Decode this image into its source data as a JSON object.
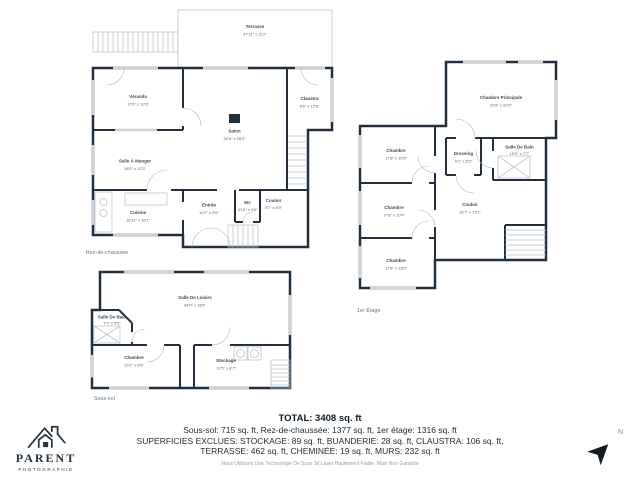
{
  "colors": {
    "wall": "#22303e",
    "line": "#b7c1c9",
    "label_text": "#3c4a56",
    "logo": "#25333f"
  },
  "plans": {
    "rdc": {
      "floor_label": "Rez-de-chaussée",
      "rooms": [
        {
          "name": "Terrasse",
          "dims": "47'11\" x 11'2\""
        },
        {
          "name": "Véranda",
          "dims": "17'6\" x 12'6\""
        },
        {
          "name": "Claustra",
          "dims": "8'6\" x 12'6\""
        },
        {
          "name": "Salon",
          "dims": "20'8\" x 26'0\""
        },
        {
          "name": "Salle À Manger",
          "dims": "18'0\" x 12'3\""
        },
        {
          "name": "Cuisine",
          "dims": "16'11\" x 10'1\""
        },
        {
          "name": "Entrée",
          "dims": "10'7\" x 9'6\""
        },
        {
          "name": "Wc",
          "dims": "4'10\" x 4'6\""
        },
        {
          "name": "Couloir",
          "dims": "4'7\" x 6'0\""
        }
      ]
    },
    "etage1": {
      "floor_label": "1er Étage",
      "rooms": [
        {
          "name": "Chambre Principale",
          "dims": "20'8\" x 20'2\""
        },
        {
          "name": "Chambre",
          "dims": "17'8\" x 10'9\""
        },
        {
          "name": "Dressing",
          "dims": "6'1\" x 5'2\""
        },
        {
          "name": "Salle De Bain",
          "dims": "10'0\" x 7'7\""
        },
        {
          "name": "Chambre",
          "dims": "17'8\" x 10'4\""
        },
        {
          "name": "Couloir",
          "dims": "16'7\" x 13'1\""
        },
        {
          "name": "Chambre",
          "dims": "17'8\" x 13'5\""
        }
      ]
    },
    "soussol": {
      "floor_label": "Sous-sol",
      "rooms": [
        {
          "name": "Salle De Loisirs",
          "dims": "34'0\" x 18'5\""
        },
        {
          "name": "Salle De Bain",
          "dims": "7'7\" x 5'5\""
        },
        {
          "name": "Chambre",
          "dims": "15'1\" x 9'4\""
        },
        {
          "name": "Stockage",
          "dims": "10'5\" x 8'7\""
        }
      ]
    }
  },
  "summary": {
    "total": "TOTAL: 3408 sq. ft",
    "line1": "Sous-sol: 715 sq. ft, Rez-de-chaussée: 1377 sq. ft, 1er étage: 1316 sq. ft",
    "line2": "SUPERFICIES EXCLUES: STOCKAGE: 89 sq. ft, BUANDERIE: 28 sq. ft, CLAUSTRA: 106 sq. ft,",
    "line3": "TERRASSE: 462 sq. ft, CHEMINÉE: 19 sq. ft, MURS: 232 sq. ft",
    "disclaimer": "Nous Utilisons Une Technologie De Scan 3d Laser Hautement Fiable, Mais Non Garantie"
  },
  "logo": {
    "name": "PARENT",
    "subtitle": "PHOTOGRAPHIE"
  },
  "compass": {
    "label": "N"
  },
  "icons": {
    "north_arrow": "➤"
  }
}
